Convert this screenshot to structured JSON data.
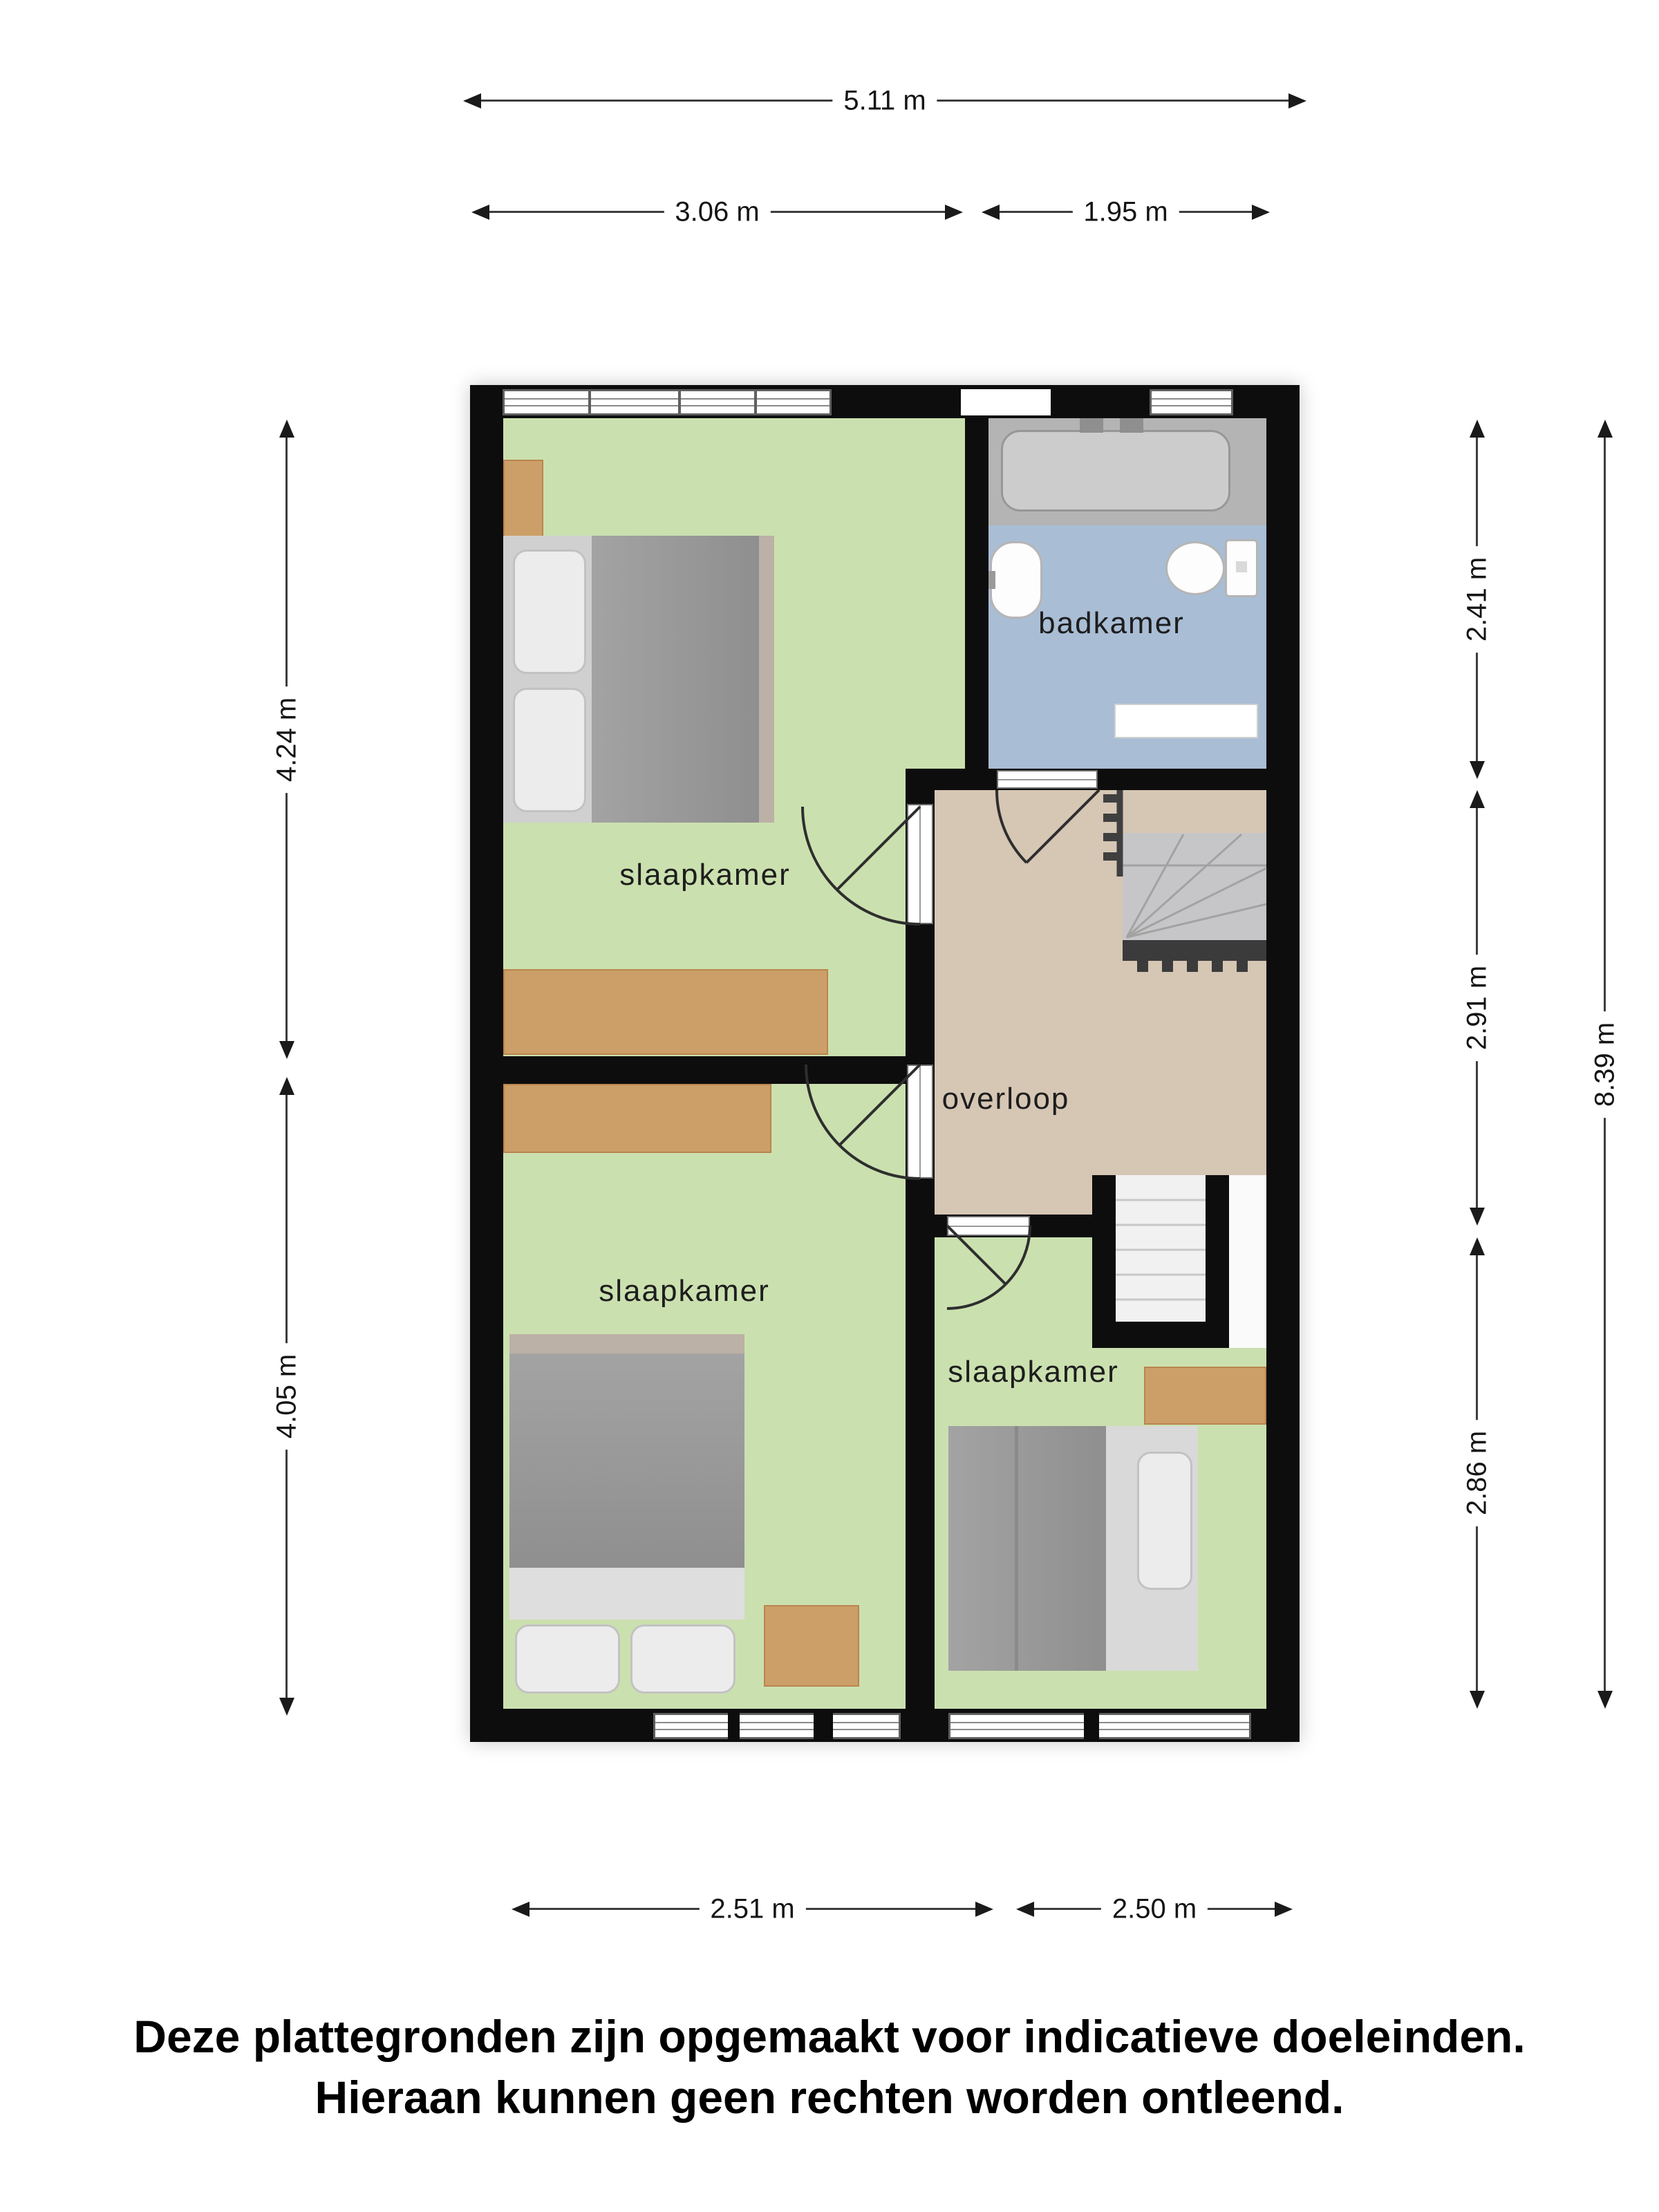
{
  "floorplan": {
    "rooms": [
      {
        "key": "slaapkamer-1",
        "label": "slaapkamer"
      },
      {
        "key": "badkamer",
        "label": "badkamer"
      },
      {
        "key": "overloop",
        "label": "overloop"
      },
      {
        "key": "slaapkamer-2",
        "label": "slaapkamer"
      },
      {
        "key": "slaapkamer-3",
        "label": "slaapkamer"
      }
    ]
  },
  "dimensions": {
    "top_total": "5.11 m",
    "top_left": "3.06 m",
    "top_right": "1.95 m",
    "left_upper": "4.24 m",
    "left_lower": "4.05 m",
    "right_upper": "2.41 m",
    "right_middle": "2.91 m",
    "right_lower": "2.86 m",
    "right_total": "8.39 m",
    "bottom_left": "2.51 m",
    "bottom_right": "2.50 m"
  },
  "disclaimer": {
    "line1": "Deze plattegronden zijn opgemaakt voor indicatieve doeleinden.",
    "line2": "Hieraan kunnen geen rechten worden ontleend."
  },
  "colors": {
    "wall": "#0d0d0d",
    "floor-green": "#cbe0af",
    "floor-blue": "#a9bdd5",
    "floor-tan": "#d6c6b4",
    "wood": "#cd9f68",
    "dim-line": "#3d3d3d",
    "label": "#1d1d1d"
  }
}
